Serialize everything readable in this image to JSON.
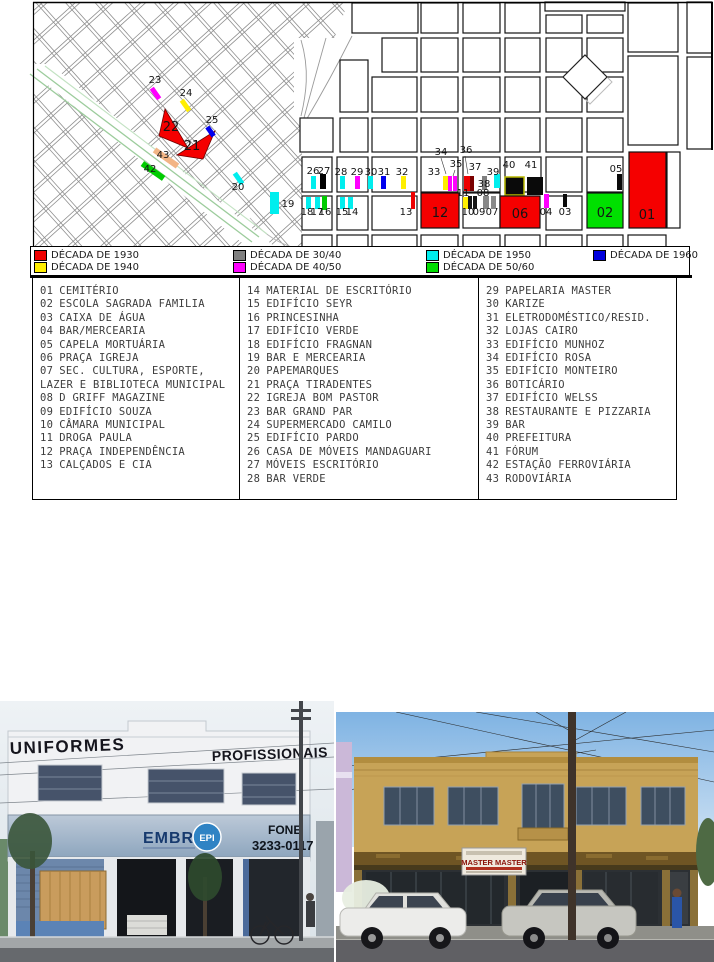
{
  "map": {
    "markers": [
      {
        "n": "23",
        "x": 155,
        "y": 83,
        "tick": [
          153,
          87,
          5,
          13,
          -35,
          "#ff00ff"
        ]
      },
      {
        "n": "24",
        "x": 186,
        "y": 96,
        "tick": [
          183,
          99,
          5,
          13,
          -35,
          "#ffee00"
        ]
      },
      {
        "n": "25",
        "x": 212,
        "y": 123,
        "tick": [
          208,
          126,
          5,
          11,
          -35,
          "#0000ee"
        ]
      },
      {
        "n": "22",
        "x": 171,
        "y": 131,
        "big": true
      },
      {
        "n": "21",
        "x": 192,
        "y": 150,
        "big": true
      },
      {
        "n": "43",
        "x": 163,
        "y": 158,
        "tick": [
          163,
          144,
          6,
          28,
          -55,
          "#f2b585"
        ]
      },
      {
        "n": "42",
        "x": 150,
        "y": 172,
        "tick": [
          150,
          158,
          6,
          26,
          -55,
          "#00cc00"
        ]
      },
      {
        "n": "20",
        "x": 238,
        "y": 190,
        "tick": [
          236,
          172,
          5,
          13,
          -35,
          "#00eeee"
        ]
      },
      {
        "n": "19",
        "x": 288,
        "y": 207,
        "tick": [
          270,
          192,
          9,
          22,
          0,
          "#00eeee"
        ]
      },
      {
        "n": "26",
        "x": 313,
        "y": 174,
        "tick": [
          311,
          176,
          5,
          13,
          0,
          "#00eeee"
        ]
      },
      {
        "n": "27",
        "x": 324,
        "y": 174,
        "tick": [
          320,
          174,
          6,
          15,
          0,
          "#000000"
        ]
      },
      {
        "n": "28",
        "x": 341,
        "y": 175,
        "tick": [
          340,
          176,
          5,
          13,
          0,
          "#00eeee"
        ]
      },
      {
        "n": "29",
        "x": 357,
        "y": 175,
        "tick": [
          355,
          176,
          5,
          13,
          0,
          "#ff00ff"
        ]
      },
      {
        "n": "30",
        "x": 371,
        "y": 175,
        "tick": [
          368,
          176,
          5,
          13,
          0,
          "#00eeee"
        ]
      },
      {
        "n": "31",
        "x": 384,
        "y": 175,
        "tick": [
          381,
          176,
          5,
          13,
          0,
          "#0000ee"
        ]
      },
      {
        "n": "32",
        "x": 402,
        "y": 175,
        "tick": [
          401,
          176,
          5,
          13,
          0,
          "#ffee00"
        ]
      },
      {
        "n": "33",
        "x": 434,
        "y": 175,
        "tick": [
          443,
          176,
          5,
          14,
          0,
          "#ffee00"
        ]
      },
      {
        "n": "34",
        "x": 441,
        "y": 155,
        "tick": [
          448,
          176,
          4,
          15,
          0,
          "#ff00ff"
        ]
      },
      {
        "n": "35",
        "x": 456,
        "y": 167,
        "tick": [
          453,
          176,
          4,
          15,
          0,
          "#ff00ff"
        ]
      },
      {
        "n": "36",
        "x": 466,
        "y": 153
      },
      {
        "n": "37",
        "x": 475,
        "y": 170,
        "tick": [
          464,
          176,
          6,
          15,
          0,
          "#ee0000"
        ]
      },
      {
        "n": "38",
        "x": 484,
        "y": 187,
        "tick": [
          482,
          176,
          5,
          14,
          0,
          "#808080"
        ]
      },
      {
        "n": "39",
        "x": 493,
        "y": 175,
        "tick": [
          494,
          174,
          6,
          14,
          0,
          "#00eeee"
        ]
      },
      {
        "n": "40",
        "x": 509,
        "y": 168,
        "tick": [
          505,
          177,
          19,
          18,
          0,
          "#0a0a0a",
          "#b8b800"
        ]
      },
      {
        "n": "41",
        "x": 531,
        "y": 168,
        "tick": [
          527,
          177,
          16,
          18,
          0,
          "#0a0a0a"
        ]
      },
      {
        "n": "05",
        "x": 616,
        "y": 172,
        "tick": [
          617,
          174,
          5,
          16,
          0,
          "#0a0a0a"
        ]
      },
      {
        "n": "11",
        "x": 463,
        "y": 196,
        "tick": [
          463,
          197,
          5,
          12,
          0,
          "#ffee00"
        ]
      },
      {
        "n": "08",
        "x": 483,
        "y": 196,
        "tick": [
          483,
          196,
          6,
          13,
          0,
          "#888888"
        ]
      },
      {
        "n": "10",
        "x": 468,
        "y": 215
      },
      {
        "n": "09",
        "x": 479,
        "y": 215
      },
      {
        "n": "07",
        "x": 492,
        "y": 215
      },
      {
        "n": "18",
        "x": 307,
        "y": 215,
        "tick": [
          306,
          197,
          5,
          12,
          0,
          "#00eeee"
        ]
      },
      {
        "n": "17",
        "x": 317,
        "y": 215,
        "tick": [
          315,
          197,
          5,
          12,
          0,
          "#00eeee"
        ]
      },
      {
        "n": "16",
        "x": 325,
        "y": 215,
        "tick": [
          322,
          196,
          5,
          14,
          0,
          "#00cc00"
        ]
      },
      {
        "n": "15",
        "x": 342,
        "y": 215,
        "tick": [
          340,
          197,
          5,
          12,
          0,
          "#00eeee"
        ]
      },
      {
        "n": "14",
        "x": 352,
        "y": 215,
        "tick": [
          348,
          197,
          5,
          12,
          0,
          "#00eeee"
        ]
      },
      {
        "n": "13",
        "x": 406,
        "y": 215,
        "tick": [
          411,
          192,
          4,
          17,
          0,
          "#ee0000"
        ]
      },
      {
        "n": "04",
        "x": 546,
        "y": 215,
        "tick": [
          544,
          194,
          5,
          14,
          0,
          "#ff00ff"
        ]
      },
      {
        "n": "03",
        "x": 565,
        "y": 215,
        "tick": [
          563,
          194,
          4,
          13,
          0,
          "#0a0a0a"
        ]
      },
      {
        "n": "12",
        "x": 440,
        "y": 217,
        "big": true,
        "block": [
          421,
          193,
          38,
          35,
          "#f50000"
        ]
      },
      {
        "n": "06",
        "x": 520,
        "y": 218,
        "big": true,
        "block": [
          500,
          196,
          40,
          32,
          "#f50000"
        ]
      },
      {
        "n": "02",
        "x": 605,
        "y": 217,
        "big": true,
        "block": [
          587,
          193,
          36,
          35,
          "#00e000"
        ]
      },
      {
        "n": "01",
        "x": 647,
        "y": 219,
        "big": true,
        "block": [
          629,
          152,
          37,
          76,
          "#f50000"
        ]
      }
    ],
    "extra_ticks": [
      [
        470,
        176,
        4,
        15,
        0,
        "#7a0000"
      ],
      [
        468,
        196,
        4,
        13,
        0,
        "#141414"
      ],
      [
        473,
        196,
        4,
        13,
        0,
        "#141414"
      ],
      [
        491,
        196,
        5,
        13,
        0,
        "#8a8a8a"
      ]
    ],
    "leaders": [
      [
        441,
        158,
        446,
        174
      ],
      [
        455,
        170,
        453,
        176
      ],
      [
        465,
        156,
        468,
        174
      ]
    ]
  },
  "legend": {
    "items": [
      {
        "label": "DÉCADA DE 1930",
        "color": "#ee0000",
        "x": 3,
        "y": 3
      },
      {
        "label": "DÉCADA DE 1940",
        "color": "#ffee00",
        "x": 3,
        "y": 15
      },
      {
        "label": "DÉCADA DE 30/40",
        "color": "#808080",
        "x": 202,
        "y": 3
      },
      {
        "label": "DÉCADA DE 40/50",
        "color": "#ff00ff",
        "x": 202,
        "y": 15
      },
      {
        "label": "DÉCADA DE 1950",
        "color": "#00eeee",
        "x": 395,
        "y": 3
      },
      {
        "label": "DÉCADA DE 50/60",
        "color": "#00dd00",
        "x": 395,
        "y": 15
      },
      {
        "label": "DÉCADA DE 1960",
        "color": "#0000dd",
        "x": 562,
        "y": 3
      }
    ]
  },
  "index": {
    "columns": [
      {
        "items": [
          {
            "num": "01",
            "name": "CEMITÉRIO"
          },
          {
            "num": "02",
            "name": "ESCOLA SAGRADA FAMILIA"
          },
          {
            "num": "03",
            "name": "CAIXA DE ÁGUA"
          },
          {
            "num": "04",
            "name": "BAR/MERCEARIA"
          },
          {
            "num": "05",
            "name": "CAPELA MORTUÁRIA"
          },
          {
            "num": "06",
            "name": "PRAÇA IGREJA"
          },
          {
            "num": "07",
            "name": "SEC. CULTURA, ESPORTE, LAZER E BIBLIOTECA MUNICIPAL"
          },
          {
            "num": "08",
            "name": "D GRIFF MAGAZINE"
          },
          {
            "num": "09",
            "name": "EDIFÍCIO SOUZA"
          },
          {
            "num": "10",
            "name": "CÂMARA MUNICIPAL"
          },
          {
            "num": "11",
            "name": "DROGA PAULA"
          },
          {
            "num": "12",
            "name": "PRAÇA INDEPENDÊNCIA"
          },
          {
            "num": "13",
            "name": "CALÇADOS E CIA"
          }
        ]
      },
      {
        "items": [
          {
            "num": "14",
            "name": "MATERIAL DE ESCRITÓRIO"
          },
          {
            "num": "15",
            "name": "EDIFÍCIO SEYR"
          },
          {
            "num": "16",
            "name": "PRINCESINHA"
          },
          {
            "num": "17",
            "name": "EDIFÍCIO VERDE"
          },
          {
            "num": "18",
            "name": "EDIFÍCIO FRAGNAN"
          },
          {
            "num": "19",
            "name": "BAR E MERCEARIA"
          },
          {
            "num": "20",
            "name": "PAPEMARQUES"
          },
          {
            "num": "21",
            "name": "PRAÇA TIRADENTES"
          },
          {
            "num": "22",
            "name": "IGREJA BOM PASTOR"
          },
          {
            "num": "23",
            "name": "BAR GRAND PAR"
          },
          {
            "num": "24",
            "name": "SUPERMERCADO CAMILO"
          },
          {
            "num": "25",
            "name": "EDIFÍCIO PARDO"
          },
          {
            "num": "26",
            "name": "CASA DE MÓVEIS MANDAGUARI"
          },
          {
            "num": "27",
            "name": "MÓVEIS ESCRITÓRIO"
          },
          {
            "num": "28",
            "name": "BAR VERDE"
          }
        ]
      },
      {
        "items": [
          {
            "num": "29",
            "name": "PAPELARIA MASTER"
          },
          {
            "num": "30",
            "name": "KARIZE"
          },
          {
            "num": "31",
            "name": "ELETRODOMÉSTICO/RESID."
          },
          {
            "num": "32",
            "name": "LOJAS CAIRO"
          },
          {
            "num": "33",
            "name": "EDIFÍCIO MUNHOZ"
          },
          {
            "num": "34",
            "name": "EDIFÍCIO ROSA"
          },
          {
            "num": "35",
            "name": "EDIFÍCIO MONTEIRO"
          },
          {
            "num": "36",
            "name": "BOTICÁRIO"
          },
          {
            "num": "37",
            "name": "EDIFÍCIO WELSS"
          },
          {
            "num": "38",
            "name": "RESTAURANTE E PIZZARIA"
          },
          {
            "num": "39",
            "name": "BAR"
          },
          {
            "num": "40",
            "name": "PREFEITURA"
          },
          {
            "num": "41",
            "name": "FÓRUM"
          },
          {
            "num": "42",
            "name": "ESTAÇÃO FERROVIÁRIA"
          },
          {
            "num": "43",
            "name": "RODOVIÁRIA"
          }
        ]
      }
    ]
  },
  "photos": {
    "left": {
      "sign_left": "UNIFORMES",
      "sign_right": "PROFISSIONAIS",
      "brand": "EMBRA",
      "badge": "EPI",
      "phone_label": "FONE",
      "phone": "3233-0117"
    },
    "right": {
      "sign": "MASTER MASTER"
    }
  }
}
